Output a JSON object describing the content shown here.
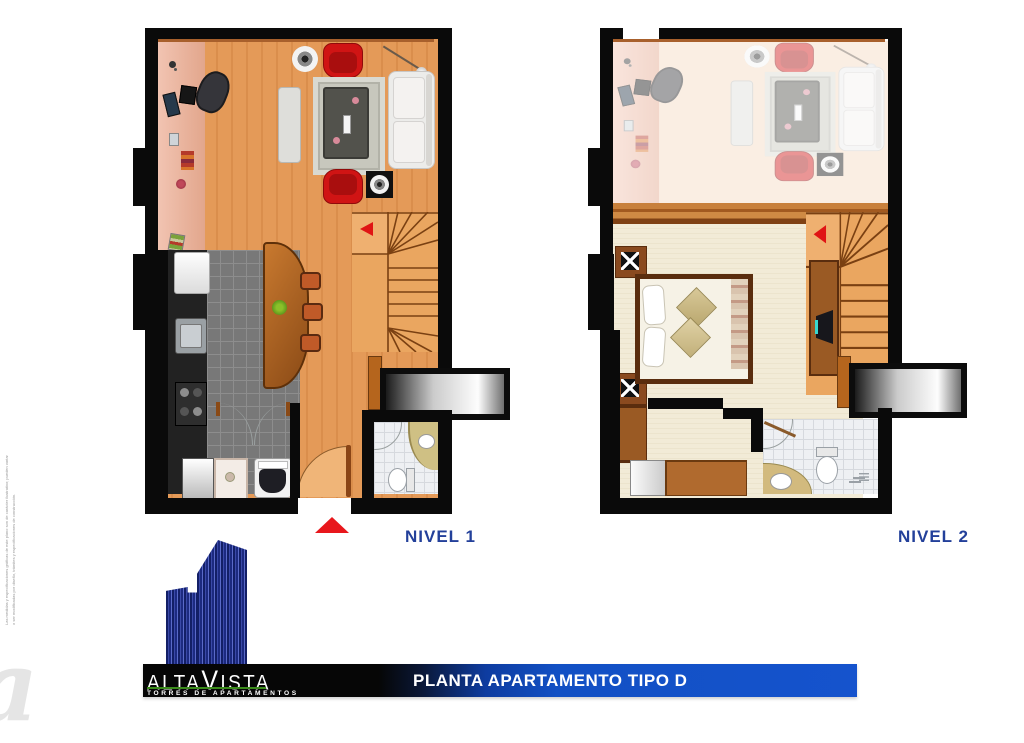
{
  "banner": {
    "text": "PLANTA APARTAMENTO TIPO D"
  },
  "levels": {
    "level1": "NIVEL 1",
    "level2": "NIVEL 2"
  },
  "logo": {
    "brand_pre": "ALTA",
    "brand_v": "V",
    "brand_post": "ISTA",
    "tagline": "TORRES DE APARTAMENTOS"
  },
  "fine_print": "Las medidas y especificaciones gráficas de este plano son de carácter ilustrativo; pueden variar o ser modificadas por diseño, trámites y especificaciones de construcción.",
  "watermark_glyph": "a",
  "colors": {
    "wall": "#0a0a0a",
    "wood_floor": "#e49a58",
    "study_strip": "#eab4a0",
    "kitchen_tile": "#787878",
    "bath_tile": "#eef0f3",
    "bedroom_carpet": "#f1ead6",
    "accent_red": "#d01414",
    "label_blue": "#23409a",
    "banner_blue": "#1553cd",
    "logo_green": "#3a8a1a",
    "tower_blue": "#1c2a80"
  }
}
